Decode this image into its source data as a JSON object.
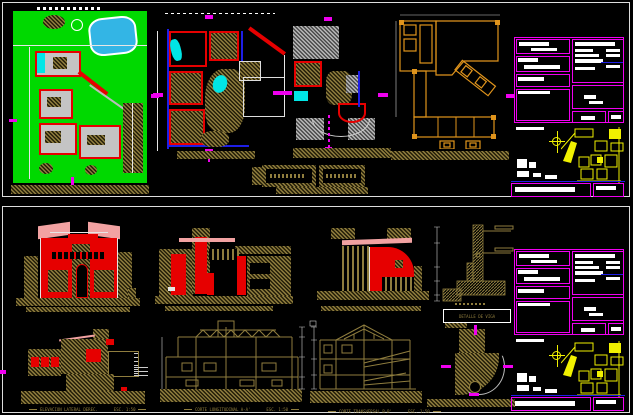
{
  "canvas": {
    "width": 633,
    "height": 415,
    "background": "#000000"
  },
  "palette": {
    "sheet_border": "#dddddd",
    "grass_green": "#00d900",
    "pool_blue": "#33b5e5",
    "wall_red": "#e60000",
    "accent_blue": "#1e1ee6",
    "fixture_cyan": "#00e6e6",
    "hatch_olive": "#8f7d3e",
    "hatch_olive_dark": "#241e08",
    "hatch_gray": "#b8b8b8",
    "marker_magenta": "#f000f0",
    "foundation_orange": "#e0941c",
    "roof_pink": "#f2a2a2",
    "map_yellow": "#f0f000",
    "titleblock_magenta": "#f000f0"
  },
  "icons": {
    "north_arrow": "crosshair-circle"
  },
  "labels": {
    "beam_detail": "DETALLE DE VIGA",
    "lateral_elevation": "ELEVACION LATERAL DEREC.",
    "lateral_elevation_scale": "ESC. 1:50",
    "longitudinal_section": "CORTE LONGITUDINAL A-A'",
    "longitudinal_section_scale": "ESC. 1:50",
    "transversal_section": "CORTE TRANSVERSAL B-B'",
    "transversal_section_scale": "ESC. 1:50"
  }
}
